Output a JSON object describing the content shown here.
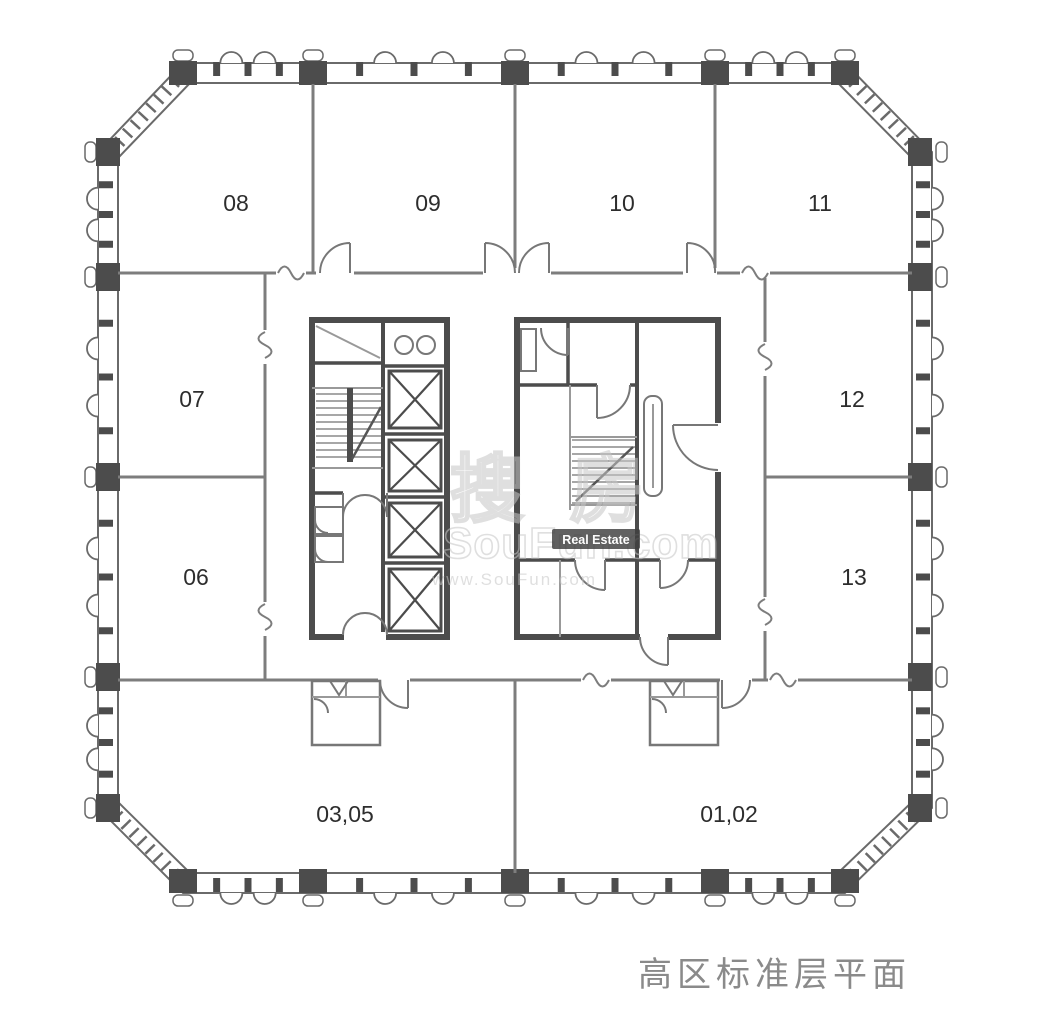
{
  "plan": {
    "caption": "高区标准层平面",
    "rooms": [
      {
        "label": "08"
      },
      {
        "label": "09"
      },
      {
        "label": "10"
      },
      {
        "label": "11"
      },
      {
        "label": "07"
      },
      {
        "label": "12"
      },
      {
        "label": "06"
      },
      {
        "label": "13"
      },
      {
        "label": "03,05"
      },
      {
        "label": "01,02"
      }
    ]
  },
  "watermark": {
    "logo": "搜房",
    "site": "SouFun.com",
    "badge": "Real Estate",
    "url": "www.SouFun.com"
  },
  "colors": {
    "background": "#ffffff",
    "wall_dark": "#4c4c4c",
    "wall_line": "#6a6a6a",
    "partition": "#7d7d7d",
    "fixture": "#777777",
    "label_text": "#2d2d2d",
    "caption_text": "#8a8a8a",
    "watermark": "#c6c6c6",
    "badge_bg": "#3f3f3f",
    "badge_text": "#ffffff"
  }
}
